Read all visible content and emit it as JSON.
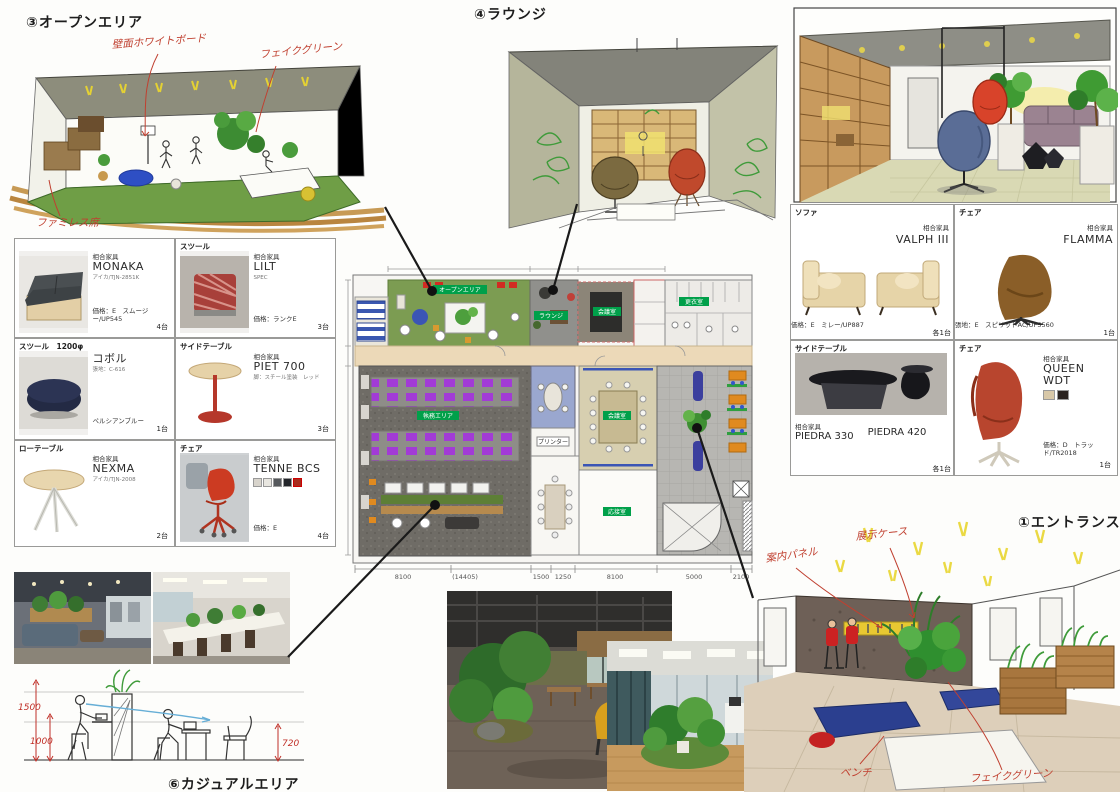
{
  "titles": {
    "open_area": "③オープンエリア",
    "lounge": "④ラウンジ",
    "entrance": "①エントランス",
    "casual": "⑥カジュアルエリア"
  },
  "sketch_notes": {
    "open_area": {
      "a0": "壁面ホワイトボード",
      "a1": "フェイクグリーン",
      "a2": "ファミレス席"
    },
    "entrance": {
      "a0": "案内パネル",
      "a1": "展示ケース",
      "a2": "ベンチ",
      "a3": "フェイクグリーン"
    },
    "casual": {
      "d0": "1500",
      "d1": "1000",
      "d2": "720"
    }
  },
  "furniture_left": [
    {
      "header": "",
      "maker": "相合家具",
      "name": "MONAKA",
      "spec": "アイカ/TJN-2851K",
      "price": "価格：E　スムージー/UP545",
      "qty": "4台"
    },
    {
      "header": "スツール",
      "maker": "相合家具",
      "name": "LILT",
      "spec": "SPEC",
      "price": "価格：ランクE",
      "qty": "3台"
    },
    {
      "header": "スツール　1200φ",
      "maker": "",
      "name": "コボル",
      "spec": "張地：C-616",
      "price": "ペルシアンブルー",
      "qty": "1台"
    },
    {
      "header": "サイドテーブル",
      "maker": "相合家具",
      "name": "PIET 700",
      "spec": "脚：スチール塗装　レッド",
      "price": "",
      "qty": "3台"
    },
    {
      "header": "ローテーブル",
      "maker": "相合家具",
      "name": "NEXMA",
      "spec": "アイカ/TJN-2008",
      "price": "",
      "qty": "2台"
    },
    {
      "header": "チェア",
      "maker": "相合家具",
      "name": "TENNE BCS",
      "spec": "",
      "price": "価格：E",
      "qty": "4台"
    }
  ],
  "furniture_right": [
    {
      "header": "ソファ",
      "maker": "相合家具",
      "name": "VALPH III",
      "price": "価格：E　ミレー/UP887",
      "qty": "各1台"
    },
    {
      "header": "チェア",
      "maker": "相合家具",
      "name": "FLAMMA",
      "price": "張地：E　スピリットAC/UP5560",
      "qty": "1台"
    },
    {
      "header": "サイドテーブル",
      "maker": "相合家具",
      "name": "PIEDRA 330",
      "name2": "PIEDRA 420",
      "price": "",
      "qty": "各1台"
    },
    {
      "header": "チェア",
      "maker": "相合家具",
      "name": "QUEEN WDT",
      "price": "価格：D　トラッド/TR2018",
      "qty": "1台"
    }
  ],
  "floor_plan": {
    "labels": [
      "オープンエリア",
      "ラウンジ",
      "会議室",
      "更衣室",
      "執務エリア",
      "会議室",
      "応接室",
      "プリンター"
    ],
    "dims": [
      "8100",
      "1500",
      "1250",
      "8100",
      "5000",
      "2100"
    ],
    "dim_note": "(14405)"
  }
}
